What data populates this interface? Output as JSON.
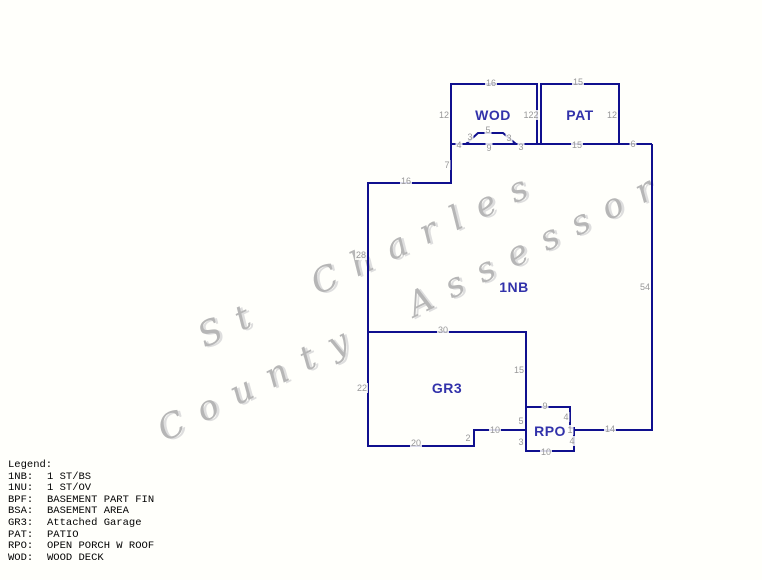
{
  "watermark": {
    "line1": "St Charles",
    "line2": "County Assessor",
    "color": "#b6b6b6"
  },
  "sketch": {
    "line_color": "#10108e",
    "area_label_color": "#3232aa",
    "dimension_color": "#989898",
    "area_labels": [
      {
        "text": "WOD",
        "x": 493,
        "y": 115
      },
      {
        "text": "PAT",
        "x": 580,
        "y": 115
      },
      {
        "text": "1NB",
        "x": 514,
        "y": 287
      },
      {
        "text": "GR3",
        "x": 447,
        "y": 388
      },
      {
        "text": "RPO",
        "x": 550,
        "y": 431
      }
    ],
    "dimensions": [
      {
        "text": "16",
        "x": 491,
        "y": 83
      },
      {
        "text": "12",
        "x": 444,
        "y": 115
      },
      {
        "text": "122",
        "x": 531,
        "y": 115
      },
      {
        "text": "15",
        "x": 578,
        "y": 82
      },
      {
        "text": "12",
        "x": 612,
        "y": 115
      },
      {
        "text": "4",
        "x": 459,
        "y": 145
      },
      {
        "text": "3",
        "x": 470,
        "y": 137
      },
      {
        "text": "5",
        "x": 488,
        "y": 130
      },
      {
        "text": "3",
        "x": 509,
        "y": 138
      },
      {
        "text": "9",
        "x": 489,
        "y": 148
      },
      {
        "text": "3",
        "x": 521,
        "y": 147
      },
      {
        "text": "15",
        "x": 577,
        "y": 145
      },
      {
        "text": "6",
        "x": 633,
        "y": 144
      },
      {
        "text": "7",
        "x": 447,
        "y": 165
      },
      {
        "text": "16",
        "x": 406,
        "y": 181
      },
      {
        "text": "28",
        "x": 361,
        "y": 255
      },
      {
        "text": "54",
        "x": 645,
        "y": 287
      },
      {
        "text": "30",
        "x": 443,
        "y": 330
      },
      {
        "text": "22",
        "x": 362,
        "y": 388
      },
      {
        "text": "15",
        "x": 519,
        "y": 370
      },
      {
        "text": "20",
        "x": 416,
        "y": 443
      },
      {
        "text": "2",
        "x": 468,
        "y": 438
      },
      {
        "text": "10",
        "x": 495,
        "y": 430
      },
      {
        "text": "9",
        "x": 545,
        "y": 406
      },
      {
        "text": "4",
        "x": 566,
        "y": 417
      },
      {
        "text": "1",
        "x": 570,
        "y": 430
      },
      {
        "text": "4",
        "x": 572,
        "y": 441
      },
      {
        "text": "5",
        "x": 521,
        "y": 421
      },
      {
        "text": "3",
        "x": 521,
        "y": 442
      },
      {
        "text": "10",
        "x": 546,
        "y": 452
      },
      {
        "text": "14",
        "x": 610,
        "y": 429
      }
    ]
  },
  "legend": {
    "title": "Legend:",
    "entries": [
      {
        "code": "1NB:",
        "desc": "1 ST/BS"
      },
      {
        "code": "1NU:",
        "desc": "1 ST/OV"
      },
      {
        "code": "BPF:",
        "desc": "BASEMENT PART FIN"
      },
      {
        "code": "BSA:",
        "desc": "BASEMENT AREA"
      },
      {
        "code": "GR3:",
        "desc": "Attached Garage"
      },
      {
        "code": "PAT:",
        "desc": "PATIO"
      },
      {
        "code": "RPO:",
        "desc": "OPEN PORCH W ROOF"
      },
      {
        "code": "WOD:",
        "desc": "WOOD DECK"
      }
    ]
  }
}
